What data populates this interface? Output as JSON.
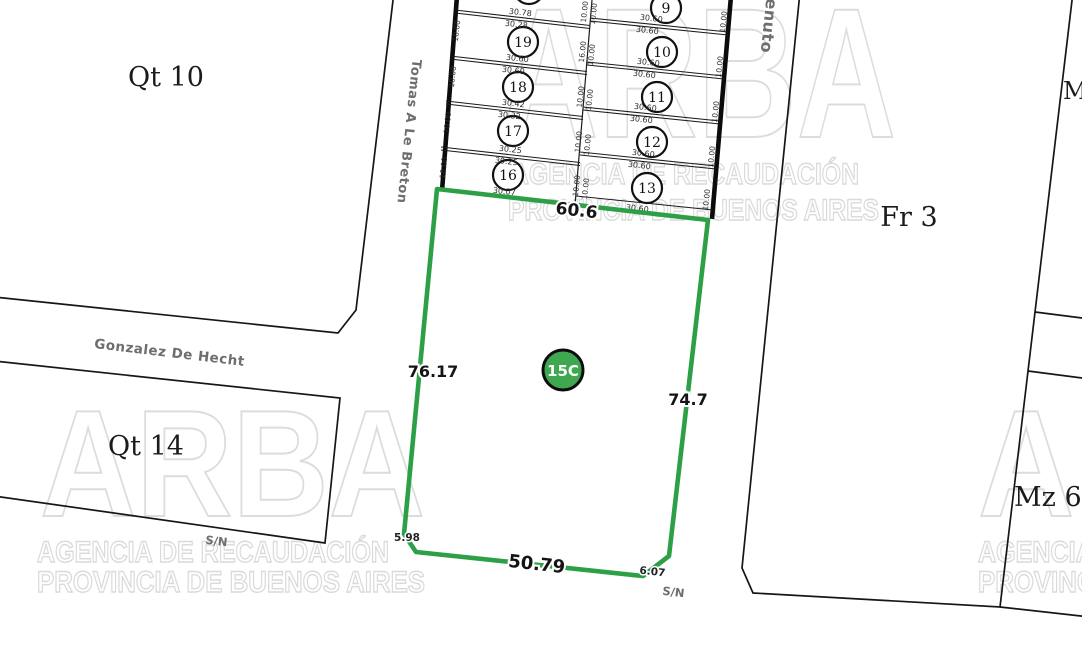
{
  "watermark": {
    "brand": "ARBA",
    "line1": "AGENCIA DE RECAUDACIÓN",
    "line2": "PROVINCIA DE BUENOS AIRES",
    "color": "#dcdcdc"
  },
  "blocks": {
    "qt10": "Qt 10",
    "qt14": "Qt 14",
    "fr3": "Fr 3",
    "m_edge": "M",
    "mz69": "Mz 69"
  },
  "streets": {
    "tomas_a_le_breton": "Tomas A Le Breton",
    "gonzalez_de_hecht": "Gonzalez De Hecht",
    "benvenuto": "Benvenuto",
    "sn_left": "S/N",
    "sn_bottom": "S/N"
  },
  "parcel": {
    "id": "15C",
    "top": "60.6",
    "left": "76.17",
    "right": "74.7",
    "bottom": "50.79",
    "corner_bl": "5.98",
    "corner_br": "6.07",
    "line_color": "#2da047",
    "badge_color": "#3fa750"
  },
  "left_column": {
    "circles": [
      "19",
      "18",
      "17",
      "16"
    ],
    "pairs": [
      [
        "30.78",
        "30.28"
      ],
      [
        "30.60",
        "30.60"
      ],
      [
        "30.42",
        "30.32"
      ],
      [
        "30.25",
        "30.25"
      ]
    ],
    "bottom_length": "30.07",
    "frontages": [
      "10.00",
      "10.00",
      "10.00",
      "10.00"
    ]
  },
  "right_column": {
    "circles": [
      "9",
      "10",
      "11",
      "12",
      "13"
    ],
    "pairs": [
      [
        "30.60",
        "30.60"
      ],
      [
        "30.60",
        "30.60"
      ],
      [
        "30.60",
        "30.60"
      ],
      [
        "30.60",
        "30.60"
      ]
    ],
    "bottom_length": "30.60",
    "frontages": [
      "10.00",
      "10.00",
      "10.00",
      "10.00",
      "10.00"
    ]
  },
  "middle_column": {
    "pairs": [
      [
        "10.00",
        "10.00"
      ],
      [
        "16.00",
        "10.00"
      ],
      [
        "10.00",
        "10.00"
      ],
      [
        "10.00",
        "10.00"
      ],
      [
        "10.00",
        "10.00"
      ]
    ]
  }
}
